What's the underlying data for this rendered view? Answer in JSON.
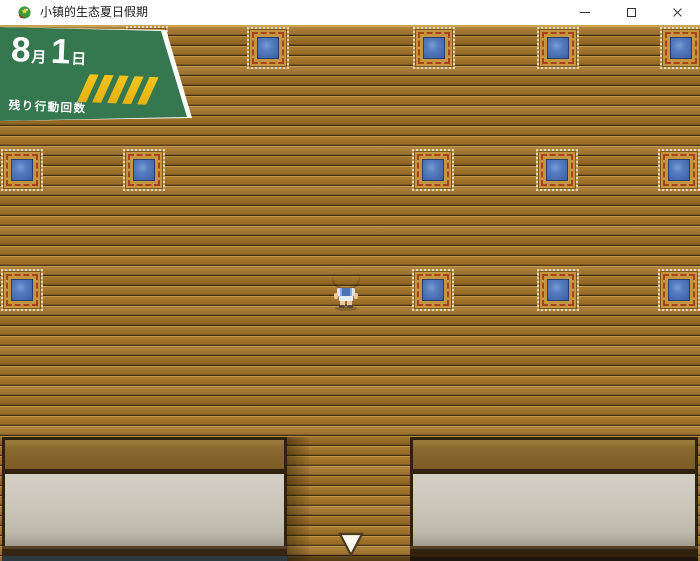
{
  "window": {
    "title": "小镇的生态夏日假期",
    "controls": [
      "minimize",
      "maximize",
      "close"
    ]
  },
  "hud": {
    "date": {
      "month": "8",
      "month_suffix": "月",
      "day": "1",
      "day_suffix": "日"
    },
    "actions_label": "残り行動回数",
    "actions_remaining": 5,
    "badge_color": "#35774e",
    "stripe_color": "#f3c41d"
  },
  "map": {
    "floor": "wood-planks",
    "carpet_color": "#4a71b5",
    "carpets": [
      {
        "x": 126,
        "y": 1
      },
      {
        "x": 247,
        "y": 2
      },
      {
        "x": 413,
        "y": 2
      },
      {
        "x": 537,
        "y": 2
      },
      {
        "x": 660,
        "y": 2
      },
      {
        "x": 1,
        "y": 124
      },
      {
        "x": 123,
        "y": 124
      },
      {
        "x": 412,
        "y": 124
      },
      {
        "x": 536,
        "y": 124
      },
      {
        "x": 658,
        "y": 124
      },
      {
        "x": 1,
        "y": 244
      },
      {
        "x": 412,
        "y": 244
      },
      {
        "x": 537,
        "y": 244
      },
      {
        "x": 658,
        "y": 244
      }
    ],
    "player": {
      "x": 331,
      "y": 241,
      "facing": "up"
    },
    "exit_indicator": {
      "x": 338,
      "y": 507,
      "direction": "down"
    }
  }
}
